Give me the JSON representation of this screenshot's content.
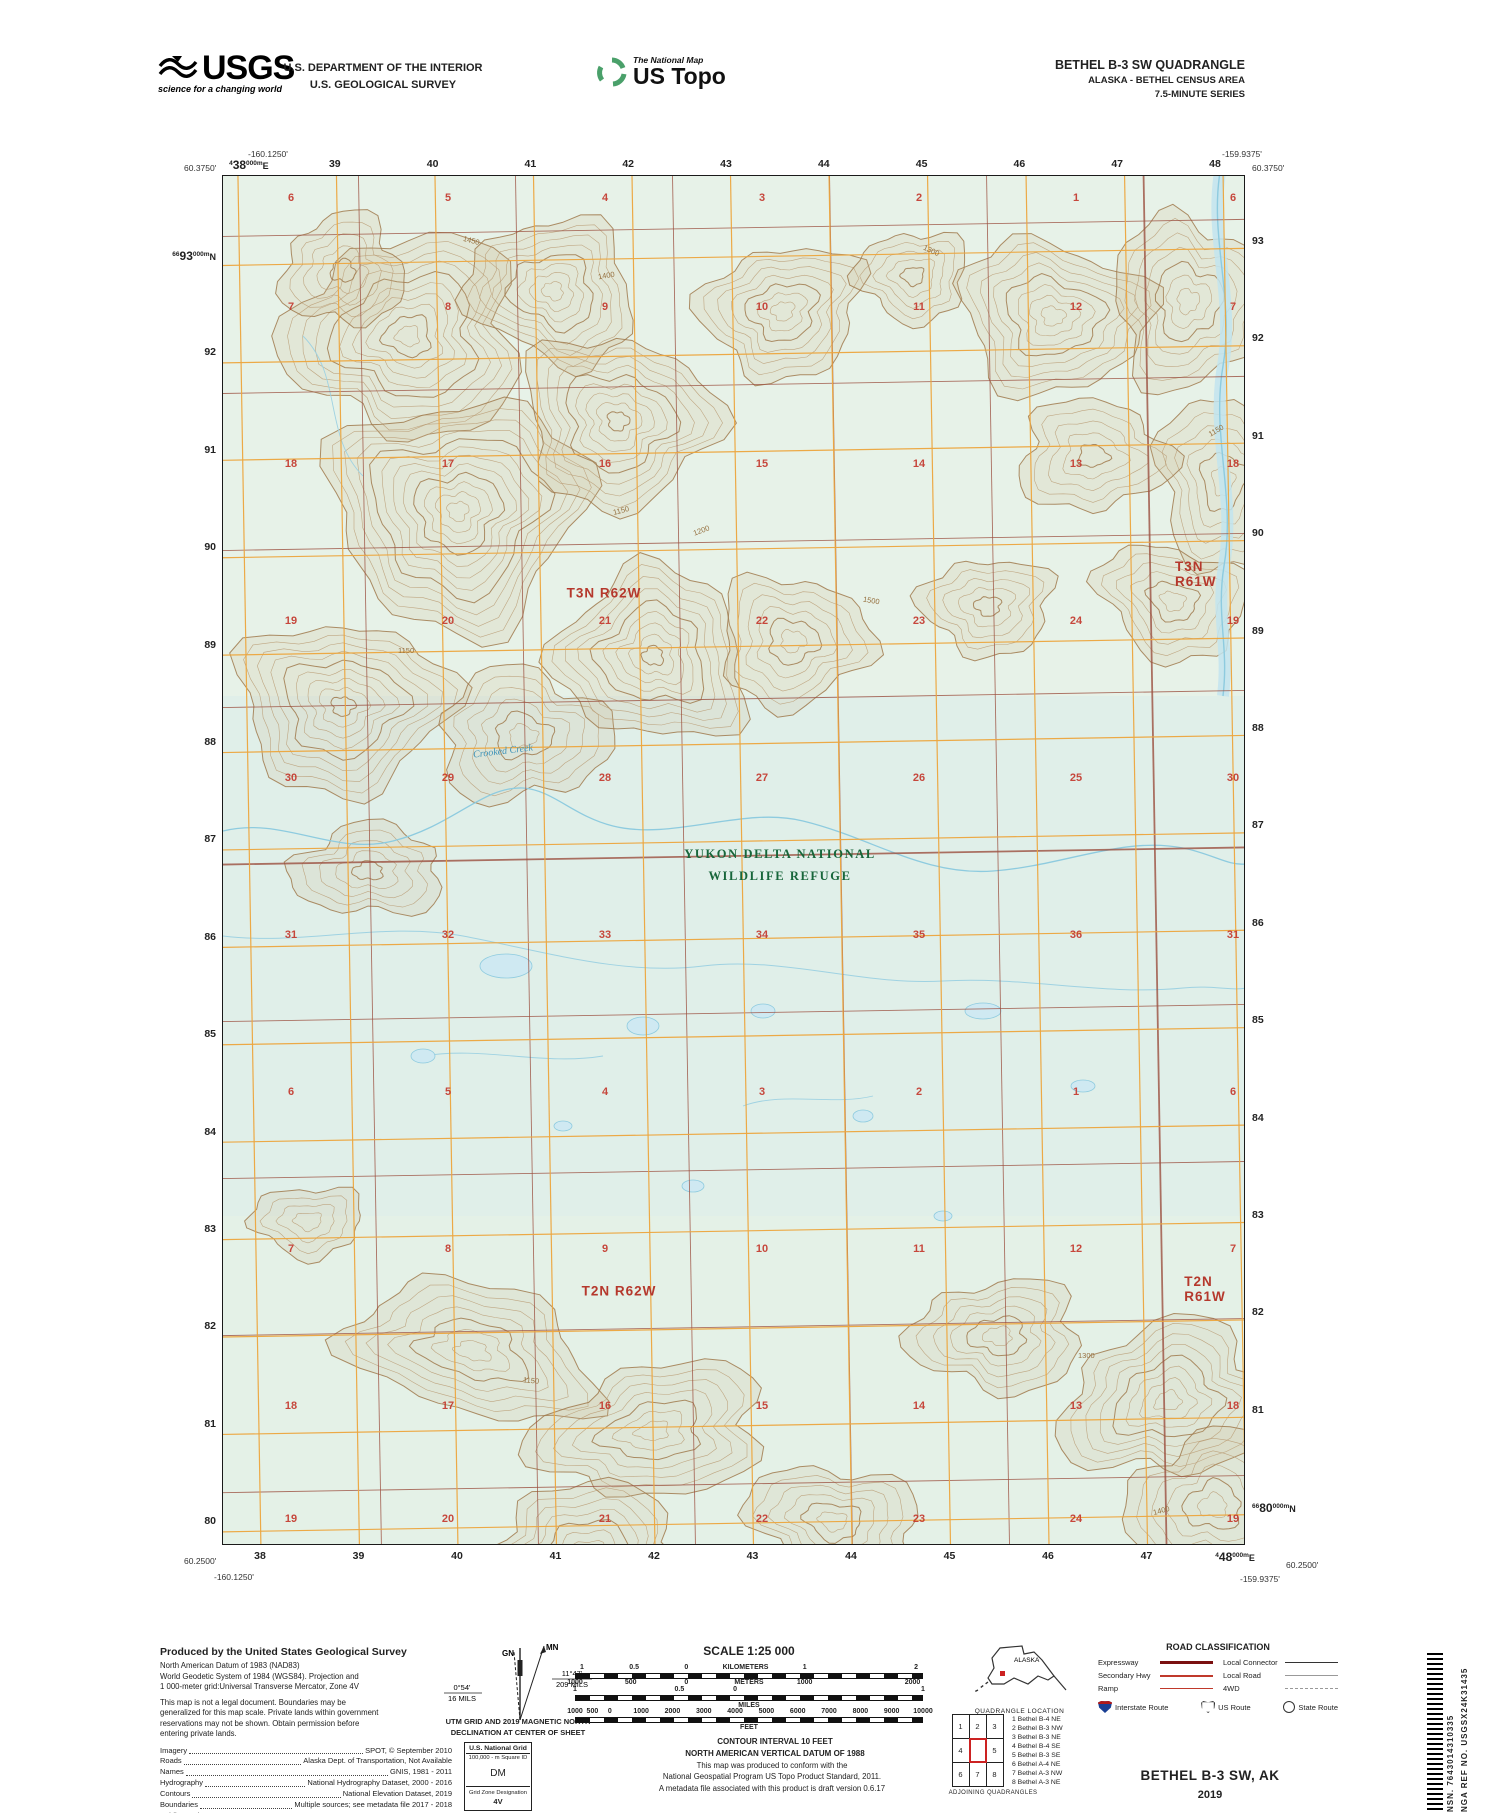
{
  "colors": {
    "grid_orange": "#eda63e",
    "plss_red": "#9c5040",
    "section_red": "#c4392e",
    "refuge_green": "#17663a",
    "water_blue": "#8ecbdf",
    "contour_brown": "#b5936b",
    "quad_location_red": "#cc2222",
    "interstate_blue": "#1a3f94"
  },
  "header": {
    "usgs": {
      "wordmark": "USGS",
      "tagline": "science for a changing world"
    },
    "dept_line1": "U.S. DEPARTMENT OF THE INTERIOR",
    "dept_line2": "U.S. GEOLOGICAL SURVEY",
    "ustopo": {
      "program": "The National Map",
      "product": "US Topo"
    },
    "quad": {
      "line1": "BETHEL B-3 SW QUADRANGLE",
      "line2": "ALASKA - BETHEL CENSUS AREA",
      "line3": "7.5-MINUTE SERIES"
    }
  },
  "map": {
    "corners": {
      "top_left_lon": "-160.1250'",
      "top_left_lat": "60.3750'",
      "top_right_lon": "-159.9375'",
      "top_right_lat": "60.3750'",
      "bottom_left_lat": "60.2500'",
      "bottom_left_lon": "-160.1250'",
      "bottom_right_lat": "60.2500'",
      "bottom_right_lon": "-159.9375'"
    },
    "edge_labels": {
      "top": [
        {
          "pre": "4",
          "main": "38",
          "suf": "000m",
          "dir": "E"
        },
        "39",
        "40",
        "41",
        "42",
        "43",
        "44",
        "45",
        "46",
        "47",
        "48"
      ],
      "bottom": [
        "38",
        "39",
        "40",
        "41",
        "42",
        "43",
        "44",
        "45",
        "46",
        "47",
        {
          "pre": "4",
          "main": "48",
          "suf": "000m",
          "dir": "E"
        }
      ],
      "left": [
        {
          "pre": "66",
          "main": "93",
          "suf": "000m",
          "dir": "N"
        },
        "92",
        "91",
        "90",
        "89",
        "88",
        "87",
        "86",
        "85",
        "84",
        "83",
        "82",
        "81",
        "80"
      ],
      "right": [
        "93",
        "92",
        "91",
        "90",
        "89",
        "88",
        "87",
        "86",
        "85",
        "84",
        "83",
        "82",
        "81",
        {
          "pre": "66",
          "main": "80",
          "suf": "000m",
          "dir": "N"
        }
      ]
    },
    "township_labels": [
      {
        "text": "T3N R62W",
        "x": 381,
        "y": 417
      },
      {
        "text": "T3N R61W",
        "x": 975,
        "y": 398
      },
      {
        "text": "T2N R62W",
        "x": 396,
        "y": 1115
      },
      {
        "text": "T2N R61W",
        "x": 982,
        "y": 1113
      }
    ],
    "refuge_label": {
      "line1": "YUKON DELTA NATIONAL",
      "line2": "WILDLIFE REFUGE",
      "x": 557,
      "y": 668
    },
    "stream_label": {
      "text": "Crooked Creek",
      "x": 250,
      "y": 570,
      "angle": -7
    },
    "section_rows": [
      {
        "y": 22,
        "numbers": [
          "6",
          "5",
          "4",
          "3",
          "2",
          "1",
          "6"
        ]
      },
      {
        "y": 131,
        "numbers": [
          "7",
          "8",
          "9",
          "10",
          "11",
          "12",
          "7"
        ]
      },
      {
        "y": 288,
        "numbers": [
          "18",
          "17",
          "16",
          "15",
          "14",
          "13",
          "18"
        ]
      },
      {
        "y": 445,
        "numbers": [
          "19",
          "20",
          "21",
          "22",
          "23",
          "24",
          "19"
        ]
      },
      {
        "y": 602,
        "numbers": [
          "30",
          "29",
          "28",
          "27",
          "26",
          "25",
          "30"
        ]
      },
      {
        "y": 759,
        "numbers": [
          "31",
          "32",
          "33",
          "34",
          "35",
          "36",
          "31"
        ]
      },
      {
        "y": 916,
        "numbers": [
          "6",
          "5",
          "4",
          "3",
          "2",
          "1",
          "6"
        ]
      },
      {
        "y": 1073,
        "numbers": [
          "7",
          "8",
          "9",
          "10",
          "11",
          "12",
          "7"
        ]
      },
      {
        "y": 1230,
        "numbers": [
          "18",
          "17",
          "16",
          "15",
          "14",
          "13",
          "18"
        ]
      },
      {
        "y": 1343,
        "numbers": [
          "19",
          "20",
          "21",
          "22",
          "23",
          "24",
          "19"
        ]
      }
    ],
    "contour_labels": [
      {
        "t": "1400",
        "x": 375,
        "y": 95,
        "a": -10
      },
      {
        "t": "1450",
        "x": 240,
        "y": 60,
        "a": 15
      },
      {
        "t": "1300",
        "x": 700,
        "y": 70,
        "a": 25
      },
      {
        "t": "1150",
        "x": 390,
        "y": 330,
        "a": -15
      },
      {
        "t": "1150",
        "x": 175,
        "y": 470,
        "a": 0
      },
      {
        "t": "1200",
        "x": 470,
        "y": 350,
        "a": -20
      },
      {
        "t": "1500",
        "x": 640,
        "y": 420,
        "a": 10
      },
      {
        "t": "1150",
        "x": 300,
        "y": 1200,
        "a": 5
      },
      {
        "t": "1300",
        "x": 855,
        "y": 1175,
        "a": 0
      },
      {
        "t": "1400",
        "x": 930,
        "y": 1330,
        "a": -15
      },
      {
        "t": "1150",
        "x": 985,
        "y": 250,
        "a": -30
      }
    ]
  },
  "footer": {
    "produced": {
      "title": "Produced by the United States Geological Survey",
      "datum_lines": [
        "North American Datum of 1983 (NAD83)",
        "World Geodetic System of 1984 (WGS84).  Projection and",
        "1 000-meter grid:Universal Transverse Mercator, Zone 4V"
      ],
      "legal_lines": [
        "This map is not a legal document. Boundaries may be",
        "generalized for this map scale. Private lands within government",
        "reservations may not be shown. Obtain permission before",
        "entering private lands."
      ],
      "credits": [
        {
          "label": "Imagery",
          "value": "SPOT,  ©  September  2010"
        },
        {
          "label": "Roads",
          "value": "Alaska Dept. of Transportation, Not Available"
        },
        {
          "label": "Names",
          "value": "GNIS, 1981 - 2011"
        },
        {
          "label": "Hydrography",
          "value": "National Hydrography Dataset, 2000 - 2016"
        },
        {
          "label": "Contours",
          "value": "National Elevation Dataset, 2019"
        },
        {
          "label": "Boundaries",
          "value": "Multiple sources; see metadata file 2017 - 2018"
        },
        {
          "label": "Public Land Survey System",
          "value": "BLM, 2008"
        },
        {
          "label": "Wetlands",
          "value": "FWS National Wetlands Inventory Not Available"
        }
      ]
    },
    "declination": {
      "caption1": "UTM GRID AND 2019 MAGNETIC NORTH",
      "caption2": "DECLINATION AT CENTER OF SHEET",
      "gn": "GN",
      "mn": "MN",
      "gn_deg": "0°54'",
      "gn_mils": "16 MILS",
      "mn_deg": "11°47'",
      "mn_mils": "209 MILS"
    },
    "usng": {
      "title": "U.S. National Grid",
      "sub": "100,000 - m Square ID",
      "square": "DM",
      "zone_label": "Grid Zone Designation",
      "zone": "4V"
    },
    "scale": {
      "title": "SCALE 1:25 000",
      "bar1_top": [
        {
          "t": "1",
          "p": 2
        },
        {
          "t": "0.5",
          "p": 17
        },
        {
          "t": "0",
          "p": 32
        },
        {
          "t": "KILOMETERS",
          "p": 49
        },
        {
          "t": "1",
          "p": 66
        },
        {
          "t": "2",
          "p": 98
        }
      ],
      "bar1_bottom": [
        {
          "t": "1000",
          "p": 0
        },
        {
          "t": "500",
          "p": 16
        },
        {
          "t": "0",
          "p": 32
        },
        {
          "t": "METERS",
          "p": 50
        },
        {
          "t": "1000",
          "p": 66
        },
        {
          "t": "2000",
          "p": 97
        }
      ],
      "bar2_top": [
        {
          "t": "1",
          "p": 0
        },
        {
          "t": "0.5",
          "p": 30
        },
        {
          "t": "0",
          "p": 46
        },
        {
          "t": "1",
          "p": 100
        }
      ],
      "bar2_unit": "MILES",
      "bar3_top": [
        {
          "t": "1000",
          "p": 0
        },
        {
          "t": "500",
          "p": 5
        },
        {
          "t": "0",
          "p": 10
        },
        {
          "t": "1000",
          "p": 19
        },
        {
          "t": "2000",
          "p": 28
        },
        {
          "t": "3000",
          "p": 37
        },
        {
          "t": "4000",
          "p": 46
        },
        {
          "t": "5000",
          "p": 55
        },
        {
          "t": "6000",
          "p": 64
        },
        {
          "t": "7000",
          "p": 73
        },
        {
          "t": "8000",
          "p": 82
        },
        {
          "t": "9000",
          "p": 91
        },
        {
          "t": "10000",
          "p": 100
        }
      ],
      "bar3_unit": "FEET"
    },
    "notes": {
      "contour1": "CONTOUR INTERVAL 10 FEET",
      "contour2": "NORTH AMERICAN VERTICAL DATUM OF 1988",
      "conform1": "This map was produced to conform with the",
      "conform2": "National Geospatial Program US Topo Product Standard, 2011.",
      "conform3": "A metadata file associated with this product is draft version 0.6.17"
    },
    "alaska": {
      "label": "ALASKA",
      "caption": "QUADRANGLE LOCATION"
    },
    "road_class": {
      "title": "ROAD CLASSIFICATION",
      "rows": [
        {
          "label": "Expressway",
          "style": "expressway"
        },
        {
          "label": "Local Connector",
          "style": "connector"
        },
        {
          "label": "Secondary Hwy",
          "style": "secondary"
        },
        {
          "label": "Local Road",
          "style": "local"
        },
        {
          "label": "Ramp",
          "style": "ramp"
        },
        {
          "label": "4WD",
          "style": "fourwd"
        }
      ],
      "shields": [
        {
          "label": "Interstate Route",
          "type": "interstate"
        },
        {
          "label": "US Route",
          "type": "us"
        },
        {
          "label": "State Route",
          "type": "state"
        }
      ]
    },
    "adjoining": {
      "cells": [
        "1",
        "2",
        "3",
        "4",
        "",
        "5",
        "6",
        "7",
        "8"
      ],
      "list": [
        "1 Bethel B-4 NE",
        "2 Bethel B-3 NW",
        "3 Bethel B-3 NE",
        "4 Bethel B-4 SE",
        "5 Bethel B-3 SE",
        "6 Bethel A-4 NE",
        "7 Bethel A-3 NW",
        "8 Bethel A-3 NE"
      ],
      "caption": "ADJOINING QUADRANGLES"
    },
    "title_block": {
      "name": "BETHEL B-3 SW,  AK",
      "year": "2019"
    },
    "sidebar": {
      "nsn_label": "NSN.",
      "nsn": "7643014310335",
      "nga_label": "NGA REF NO.",
      "nga": "USGSX24K31435"
    }
  }
}
